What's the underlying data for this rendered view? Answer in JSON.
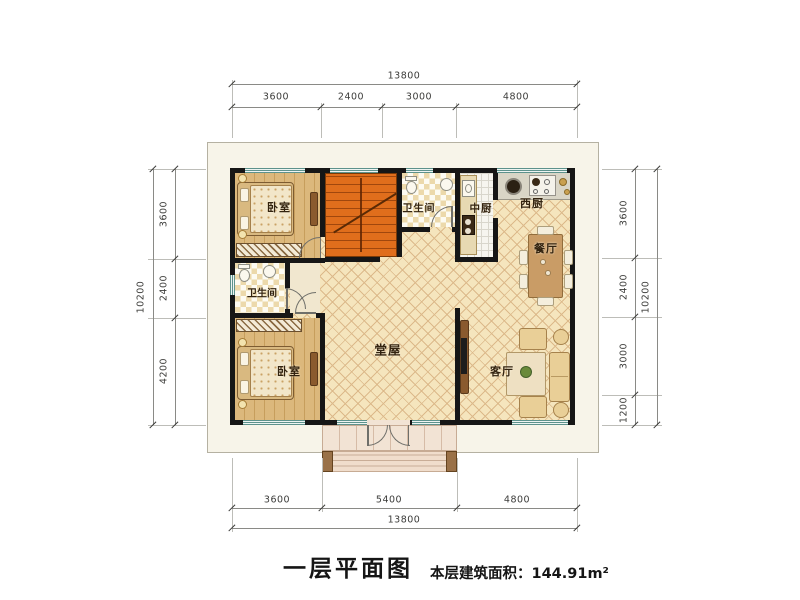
{
  "footer": {
    "title": "一层平面图",
    "area": "本层建筑面积：144.91m²"
  },
  "rooms": {
    "bedroom_top": "卧室",
    "bedroom_bottom": "卧室",
    "bath_top": "卫生间",
    "bath_left": "卫生间",
    "chinese_kitchen": "中厨",
    "western_kitchen": "西厨",
    "dining": "餐厅",
    "hall": "堂屋",
    "living": "客厅"
  },
  "dims": {
    "top": {
      "total": "13800",
      "segs": [
        "3600",
        "2400",
        "3000",
        "4800"
      ]
    },
    "bottom": {
      "total": "13800",
      "segs": [
        "3600",
        "5400",
        "4800"
      ]
    },
    "left": {
      "total": "10200",
      "segs": [
        "3600",
        "2400",
        "4200"
      ]
    },
    "right": {
      "total": "10200",
      "segs": [
        "3600",
        "2400",
        "3000",
        "1200"
      ]
    }
  },
  "colors": {
    "wall": "#161616",
    "stairs": "#e06e1c",
    "window": "#5d928c",
    "wood_floor": "#dcb87c",
    "tile_floor": "#f5e5bd"
  }
}
